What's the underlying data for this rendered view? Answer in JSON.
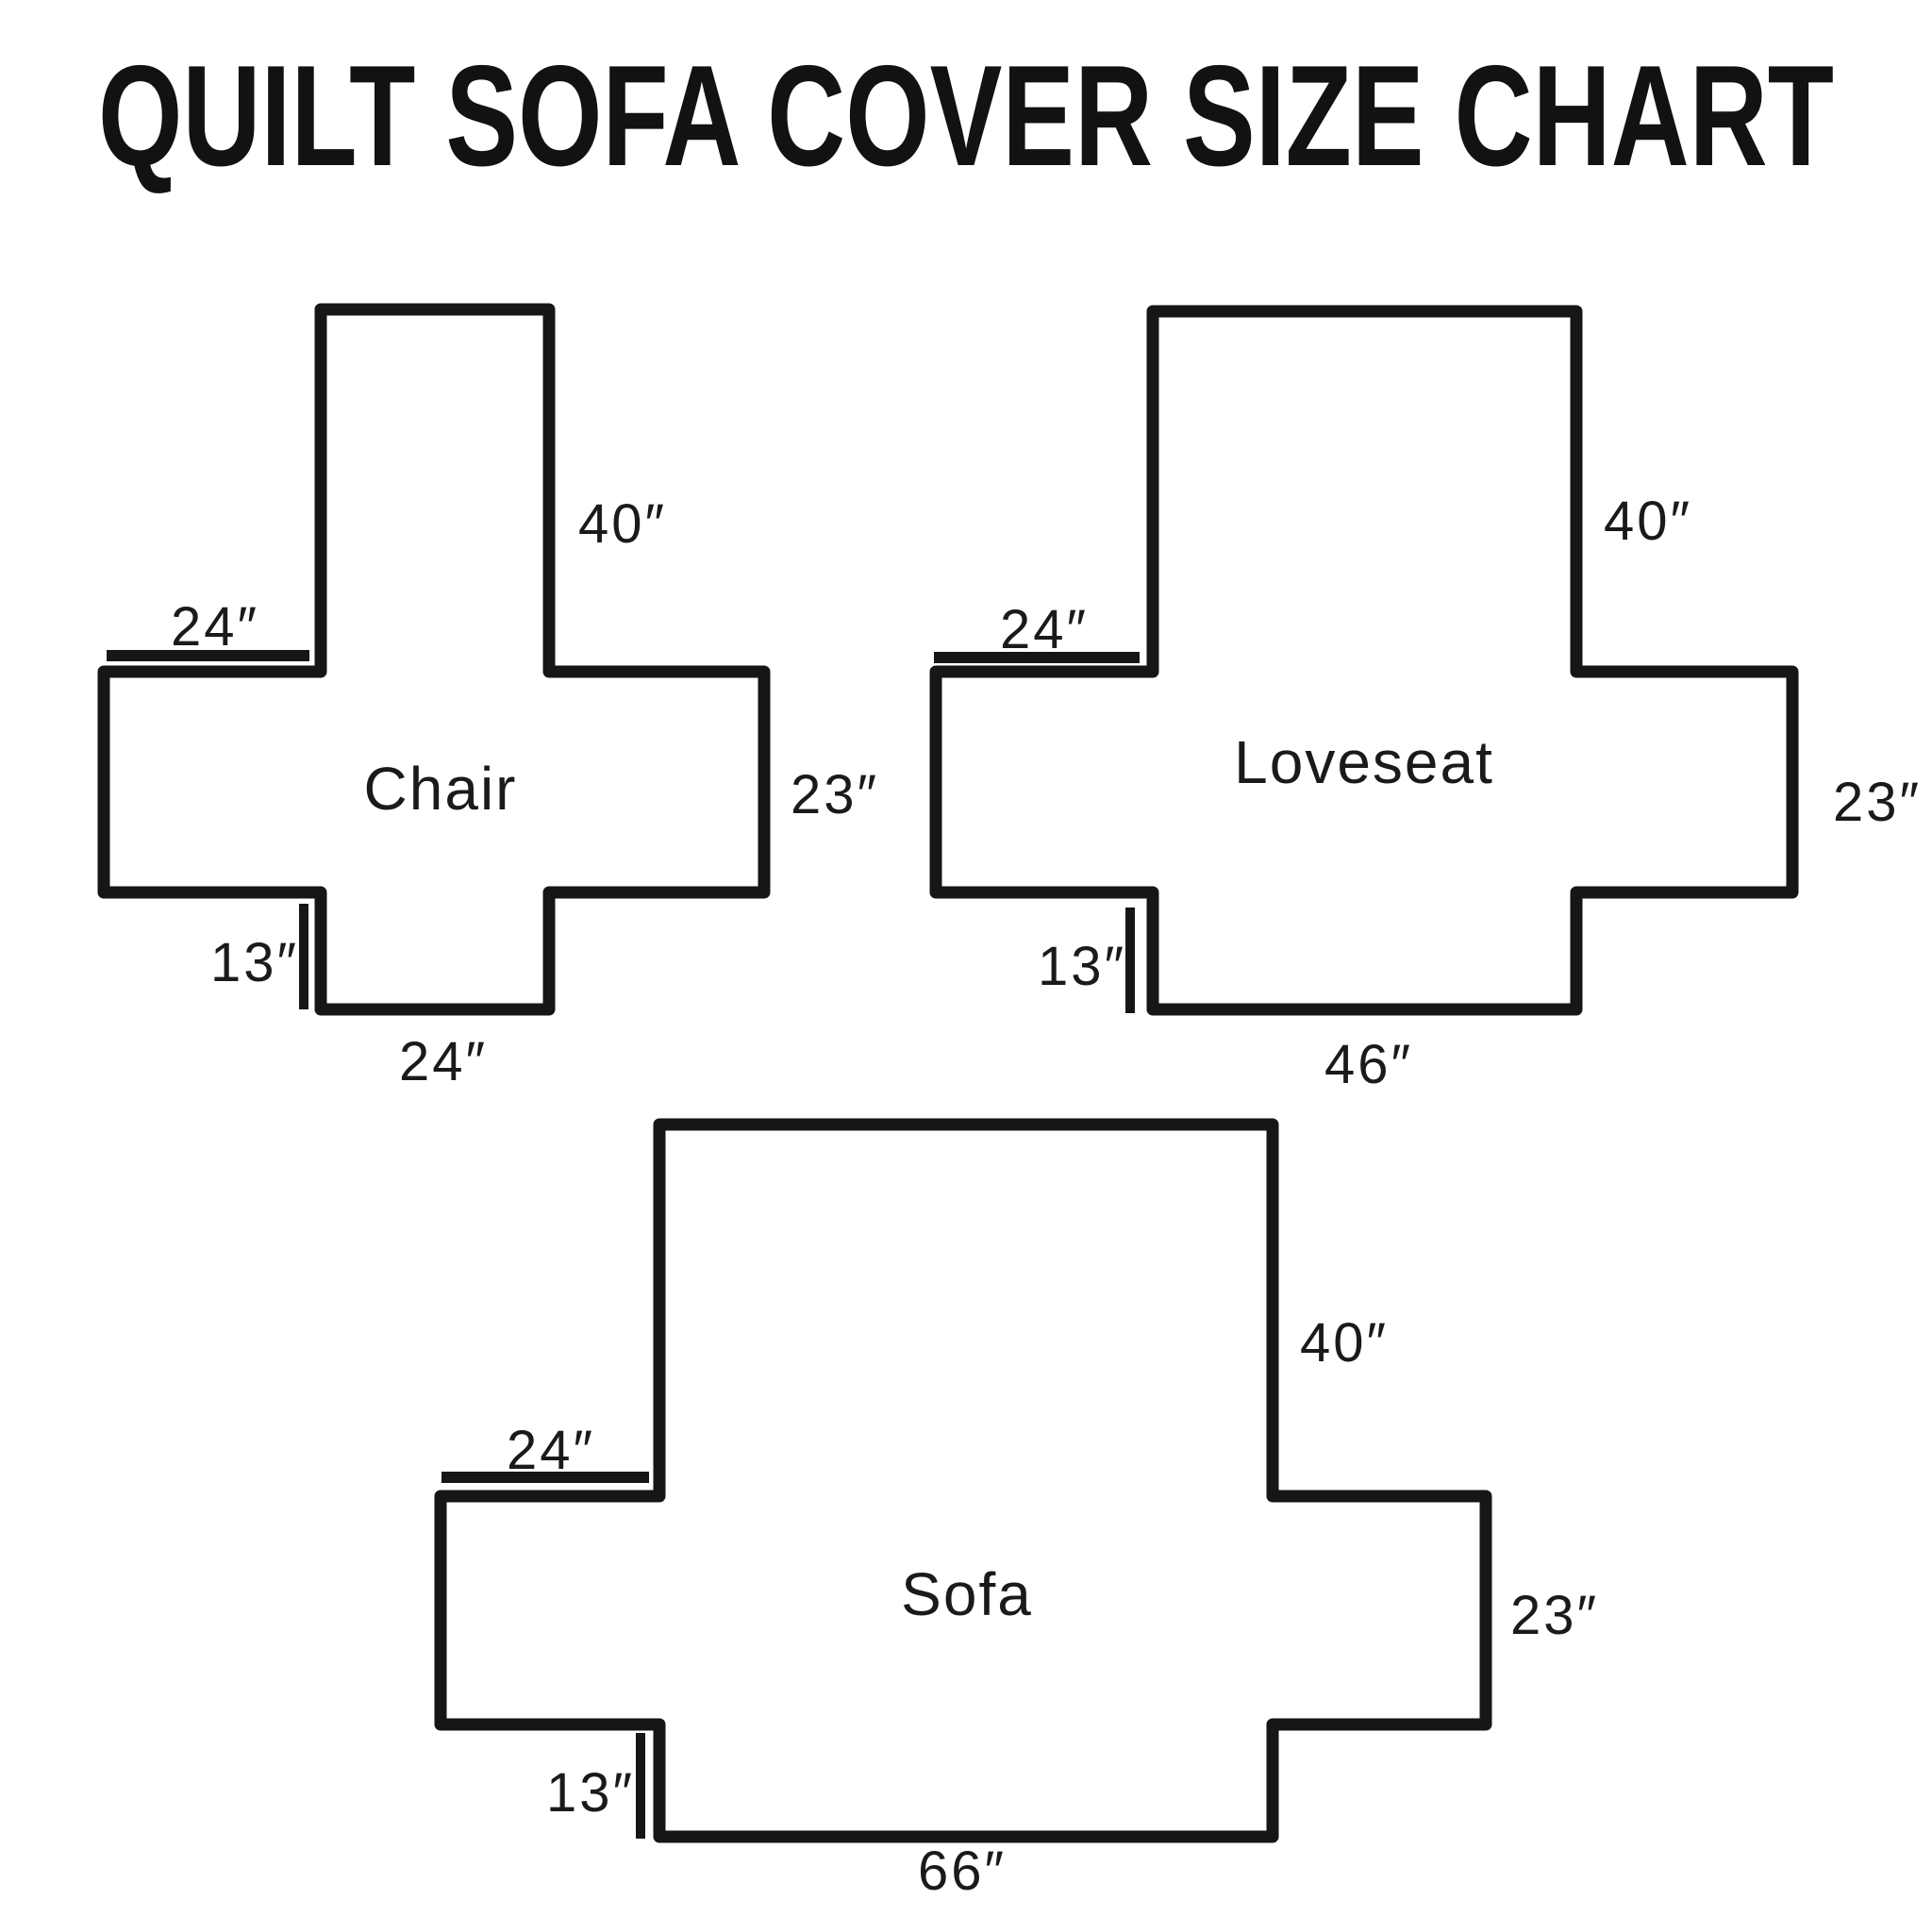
{
  "title": "QUILT SOFA COVER SIZE CHART",
  "colors": {
    "background": "#ffffff",
    "line": "#161616",
    "text": "#1a1a1a"
  },
  "diagrams": [
    {
      "name": "Chair",
      "back_height": "40″",
      "arm_top_width": "24″",
      "arm_side_height": "23″",
      "front_skirt_drop": "13″",
      "seat_front_width": "24″"
    },
    {
      "name": "Loveseat",
      "back_height": "40″",
      "arm_top_width": "24″",
      "arm_side_height": "23″",
      "front_skirt_drop": "13″",
      "seat_front_width": "46″"
    },
    {
      "name": "Sofa",
      "back_height": "40″",
      "arm_top_width": "24″",
      "arm_side_height": "23″",
      "front_skirt_drop": "13″",
      "seat_front_width": "66″"
    }
  ]
}
